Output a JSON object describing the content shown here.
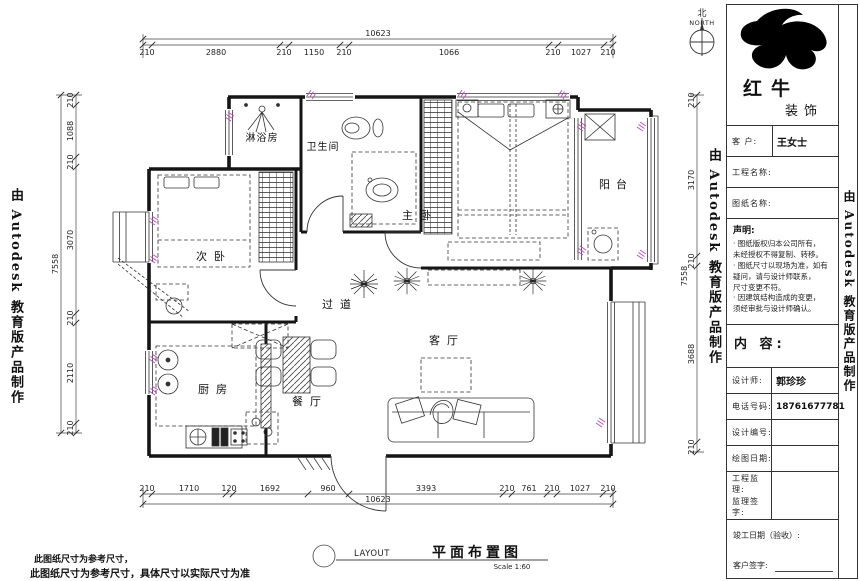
{
  "drawing": {
    "rooms": {
      "shower": "淋浴房",
      "bathroom": "卫生间",
      "master_bedroom": "主卧",
      "balcony": "阳台",
      "second_bedroom": "次卧",
      "hallway": "过道",
      "living_room": "客厅",
      "kitchen": "厨房",
      "dining_room": "餐厅"
    },
    "dims": {
      "top": {
        "overall": "10623",
        "segments": [
          "210",
          "2880",
          "210",
          "1150",
          "210",
          "1066",
          "210",
          "1027",
          "210"
        ]
      },
      "bottom": {
        "overall": "10623",
        "segments": [
          "210",
          "1710",
          "120",
          "1692",
          "960",
          "3393",
          "210",
          "761",
          "210",
          "1027",
          "210"
        ]
      },
      "left": {
        "overall": "7558",
        "segments": [
          "210",
          "1088",
          "210",
          "3070",
          "210",
          "2110",
          "210"
        ]
      },
      "right": {
        "overall": "7558",
        "segments": [
          "210",
          "3170",
          "210",
          "3688",
          "210"
        ]
      }
    },
    "compass": {
      "cn": "北",
      "en": "NORTH"
    },
    "caption": {
      "tag": "LAYOUT",
      "title": "平面布置图",
      "scale": "Scale  1:60"
    },
    "notes": {
      "line1": "此图纸尺寸为参考尺寸，",
      "line2": "此图纸尺寸为参考尺寸，具体尺寸以实际尺寸为准"
    }
  },
  "watermark": {
    "text": "由 Autodesk 教育版产品制作"
  },
  "title_block": {
    "logo": {
      "name": "红牛",
      "suffix": "装饰"
    },
    "client_label": "客 户:",
    "client_value": "王女士",
    "project_label": "工程名称:",
    "drawing_label": "图纸名称:",
    "statement_title": "声明:",
    "statement_lines": [
      "· 图纸版权归本公司所有，",
      "  未经授权不得复制、转移。",
      "· 图纸尺寸以现场为准，如有",
      "  疑问，请与设计师联系，",
      "  尺寸变更不符。",
      "· 因建筑结构造成的变更，",
      "  须经审批与设计师确认。"
    ],
    "content_label": "内 容:",
    "designer_label": "设计师:",
    "designer_value": "郭珍珍",
    "phone_label": "电话号码:",
    "phone_value": "18761677781",
    "design_no_label": "设计编号:",
    "date_label": "绘图日期:",
    "supervisor_label": "工程监理:",
    "supervisor_sign_label": "监理签字:",
    "completion_label": "竣工日期（验收）:",
    "client_sign_label": "客户签字:"
  },
  "colors": {
    "line": "#151515",
    "window_accent": "#b44fb4",
    "paper": "#ffffff"
  }
}
